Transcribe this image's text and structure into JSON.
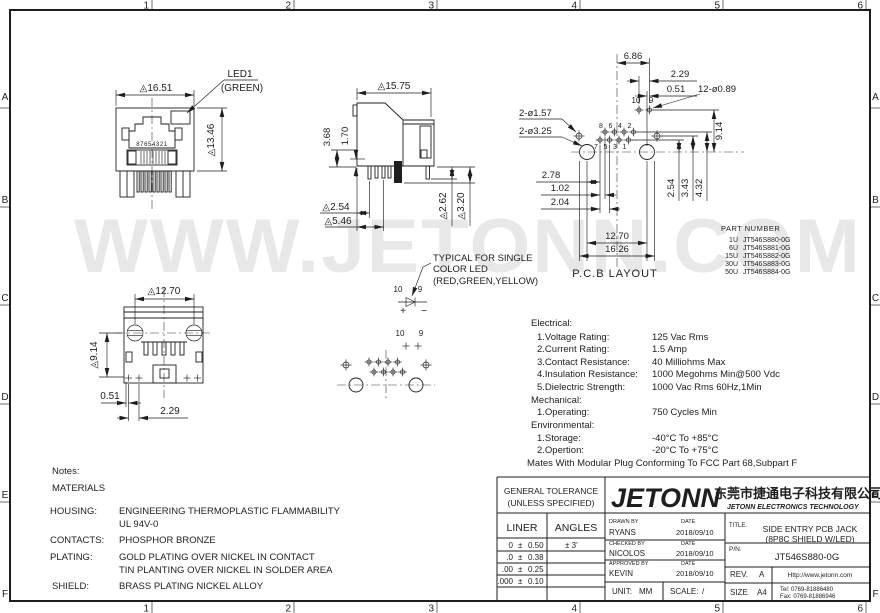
{
  "watermark": "WWW.JETONN.COM",
  "zones": {
    "cols": [
      "1",
      "2",
      "3",
      "4",
      "5",
      "6"
    ],
    "rows": [
      "A",
      "B",
      "C",
      "D",
      "E",
      "F"
    ]
  },
  "front": {
    "dim_width": "◬16.51",
    "dim_height": "◬13.46",
    "led_line1": "LED1",
    "led_line2": "(GREEN)",
    "pin_numbers": "87654321"
  },
  "side": {
    "dim_width": "◬15.75",
    "dim_368": "3.68",
    "dim_170": "1.70",
    "dim_254": "◬2.54",
    "dim_546": "◬5.46",
    "dim_262": "◬2.62",
    "dim_320": "◬3.20"
  },
  "bottom": {
    "dim_width": "◬12.70",
    "dim_height": "◬9.14",
    "dim_051": "0.51",
    "dim_229": "2.29"
  },
  "pcb": {
    "caption": "P.C.B LAYOUT",
    "dim_686": "6.86",
    "dim_229": "2.29",
    "dim_051": "0.51",
    "dim_holes": "12-ø0.89",
    "dim_157": "2-ø1.57",
    "dim_325": "2-ø3.25",
    "dim_914": "9.14",
    "dim_254": "2.54",
    "dim_343": "3.43",
    "dim_432": "4.32",
    "dim_278": "2.78",
    "dim_102": "1.02",
    "dim_204": "2.04",
    "dim_1270": "12.70",
    "dim_1626": "16.26",
    "pins_top": [
      "8",
      "6",
      "4",
      "2"
    ],
    "pins_bottom": [
      "7",
      "5",
      "3",
      "1"
    ],
    "pins_led": [
      "10",
      "9"
    ]
  },
  "led_note": {
    "line1": "TYPICAL FOR SINGLE",
    "line2": "COLOR LED",
    "line3": "(RED,GREEN,YELLOW)",
    "pins_diode": [
      "10",
      "9"
    ],
    "plus": "+",
    "minus": "−",
    "pins_foot": [
      "10",
      "9"
    ]
  },
  "part_table": {
    "title": "PART NUMBER",
    "rows": [
      {
        "plating": "1U",
        "pn": "JT546S880-0G"
      },
      {
        "plating": "6U",
        "pn": "JT546S881-0G"
      },
      {
        "plating": "15U",
        "pn": "JT546S882-0G"
      },
      {
        "plating": "30U",
        "pn": "JT546S883-0G"
      },
      {
        "plating": "50U",
        "pn": "JT546S884-0G"
      }
    ]
  },
  "specs": {
    "sections": [
      {
        "title": "Electrical:",
        "items": [
          {
            "label": "1.Voltage Rating:",
            "value": "125 Vac Rms"
          },
          {
            "label": "2.Current Rating:",
            "value": "1.5 Amp"
          },
          {
            "label": "3.Contact Resistance:",
            "value": "40 Milliohms Max"
          },
          {
            "label": "4.Insulation Resistance:",
            "value": "1000 Megohms Min@500 Vdc"
          },
          {
            "label": "5.Dielectric Strength:",
            "value": "1000 Vac Rms 60Hz,1Min"
          }
        ]
      },
      {
        "title": "Mechanical:",
        "items": [
          {
            "label": "1.Operating:",
            "value": "750 Cycles Min"
          }
        ]
      },
      {
        "title": "Environmental:",
        "items": [
          {
            "label": "1.Storage:",
            "value": "-40°C To +85°C"
          },
          {
            "label": "2.Opertion:",
            "value": "-20°C To +75°C"
          }
        ]
      }
    ],
    "footer": "Mates With Modular Plug Conforming To FCC Part 68,Subpart F"
  },
  "notes": {
    "title": "Notes:",
    "subtitle": "MATERIALS",
    "rows": [
      {
        "label": "HOUSING:",
        "line1": "ENGINEERING THERMOPLASTIC FLAMMABILITY",
        "line2": "UL 94V-0"
      },
      {
        "label": "CONTACTS:",
        "line1": "PHOSPHOR BRONZE"
      },
      {
        "label": "PLATING:",
        "line1": "GOLD PLATING OVER NICKEL IN CONTACT",
        "line2": "TIN PLANTING OVER NICKEL IN SOLDER AREA"
      },
      {
        "label": "SHIELD:",
        "line1": "BRASS PLATING NICKEL ALLOY"
      }
    ]
  },
  "title_block": {
    "tol_title1": "GENERAL TOLERANCE",
    "tol_title2": "(UNLESS SPECIFIED)",
    "col_liner": "LINER",
    "col_angles": "ANGLES",
    "pm": "±",
    "tol_rows": [
      {
        "d": "0",
        "v": "0.50",
        "a": "± 3'"
      },
      {
        "d": ".0",
        "v": "0.38"
      },
      {
        "d": ".00",
        "v": "0.25"
      },
      {
        "d": ".000",
        "v": "0.10"
      }
    ],
    "drawn_label": "DRAWN BY",
    "checked_label": "CHECKED BY",
    "approved_label": "APPROVED BY",
    "date_label": "DATE",
    "drawn_name": "RYANS",
    "checked_name": "NICOLOS",
    "approved_name": "KEVIN",
    "dates": [
      "2018/09/10",
      "2018/09/10",
      "2018/09/10"
    ],
    "unit_label": "UNIT:",
    "unit": "MM",
    "scale_label": "SCALE:",
    "scale": "/",
    "logo": "JETONN",
    "company_cn": "东莞市捷通电子科技有限公司",
    "company_en": "JETONN ELECTRONICS TECHNOLOGY",
    "title_label": "TITLE.",
    "title1": "SIDE ENTRY PCB JACK",
    "title2": "(8P8C SHIELD W/LED)",
    "pn_label": "P/N.",
    "pn": "JT546S880-0G",
    "rev_label": "REV.",
    "rev": "A",
    "size_label": "SIZE",
    "size": "A4",
    "web": "Http://www.jetonn.com",
    "tel": "Tel: 0769-81886480",
    "fax": "Fax: 0769-81886946"
  }
}
